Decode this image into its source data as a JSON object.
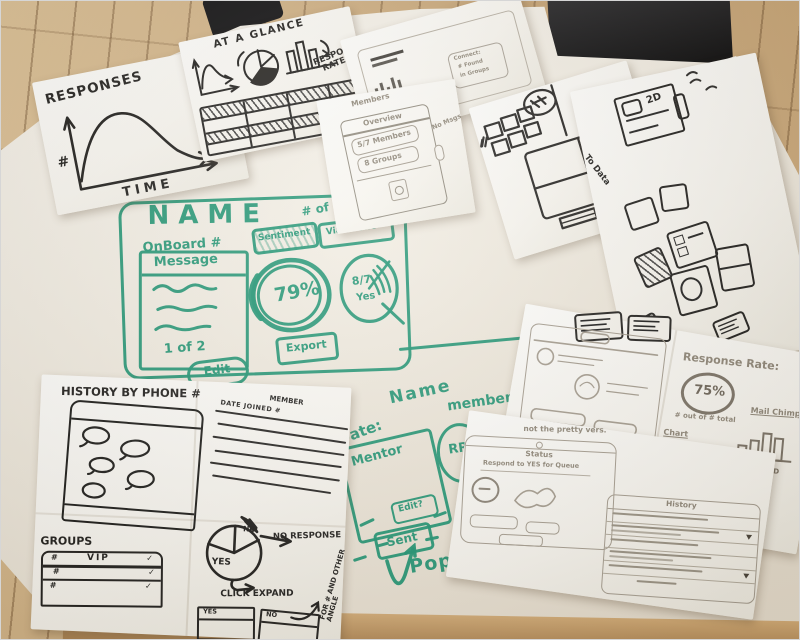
{
  "accent": {
    "marker_green": "#2a9678",
    "ink": "#222222",
    "pencil": "#8f8779",
    "wood": "#c9a878"
  },
  "sketch_notes": {
    "responses_chart": {
      "title": "RESPONSES",
      "y_axis": "#",
      "x_axis": "TIME"
    },
    "at_a_glance": {
      "title": "AT A GLANCE",
      "label_line1": "RESPONSE",
      "label_line2": "RATE"
    },
    "browser_sketch": {
      "box_line1": "Connect:",
      "box_line2": "# Found",
      "box_line3": "in Groups"
    },
    "overview_card": {
      "note_top": "Members",
      "header": "Overview",
      "stat_members": "5/7 Members",
      "stat_groups": "8 Groups",
      "note_right": "No Msgs"
    },
    "flow_sketch": {
      "vertical_note": "message",
      "to_data_note": "To Data",
      "card_label": "2D"
    },
    "history_by_phone": {
      "title": "HISTORY BY PHONE #",
      "groups_label": "GROUPS",
      "vip_table": {
        "header": "VIP",
        "rows": [
          {
            "id": "#",
            "check": "✓"
          },
          {
            "id": "#",
            "check": "✓"
          },
          {
            "id": "#",
            "check": "✓"
          }
        ]
      },
      "member_table": {
        "title": "MEMBER",
        "header": "DATE JOINED #"
      },
      "pie": {
        "slice_yes": "YES",
        "slice_no": "NO",
        "callout": "NO RESPONSE"
      },
      "expand_note": "CLICK EXPAND",
      "yes_box": "YES",
      "no_box": "NO",
      "angle_note": "FOR # AND OTHER ANGLE"
    },
    "response_rate_sheet": {
      "title": "Response Rate:",
      "value": "75%",
      "subtitle": "# out of # total",
      "chart_label": "Chart",
      "mail_label": "Mail Chimp",
      "bar_categories": [
        "A",
        "B",
        "C",
        "D"
      ],
      "status_screen": {
        "title": "Status",
        "line": "Respond to YES for Queue"
      },
      "history_screen": {
        "title": "History"
      },
      "note": "not the pretty vers."
    }
  },
  "whiteboard": {
    "dashboard": {
      "title": "NAME",
      "subtitle": "OnBoard #",
      "corner_note": "# of m",
      "message_card": {
        "header": "Message",
        "page": "1 of 2",
        "button": "Edit"
      },
      "sentiment_label": "Sentiment",
      "vibe_label": "Via Phone",
      "gauge_value": "79%",
      "pie_value": "8/7",
      "pie_caption": "Yes",
      "export_label": "Export"
    },
    "profile": {
      "date_label": "Date:",
      "name_label": "Name",
      "member_label": "member",
      "mentor_label": "Mentor",
      "edit_label": "Edit?",
      "initials": "RR",
      "sent_label": "Sent",
      "popdown_label": "Pop Down"
    }
  }
}
